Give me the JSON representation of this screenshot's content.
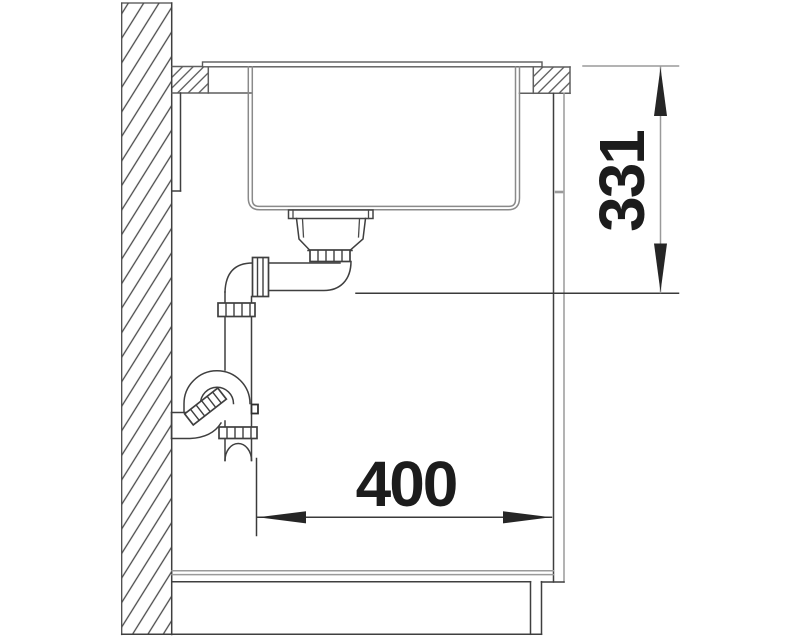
{
  "dimensions": {
    "vertical": {
      "value": "331"
    },
    "horizontal": {
      "value": "400"
    }
  },
  "colors": {
    "line": "#3f3f3f",
    "secondary_line": "#9a9a9a",
    "dimension": "#1c1c1c",
    "background": "#ffffff"
  }
}
